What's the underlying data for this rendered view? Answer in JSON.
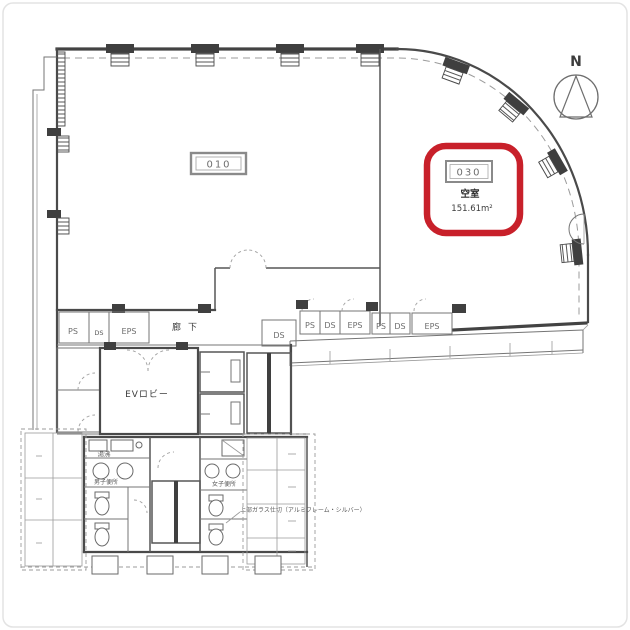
{
  "plan": {
    "compass_label": "N",
    "room_label": "010",
    "highlight": {
      "unit": "030",
      "status": "空室",
      "area": "151.61m²"
    },
    "labels": {
      "corridor": "廊下",
      "ev_lobby": "EVロビー",
      "kitchenette": "湯沸",
      "mens_toilet": "男子便所",
      "womens_toilet": "女子便所",
      "partition_note": "上部ガラス仕切（アルミフレーム・シルバー）"
    },
    "utilities": {
      "left": [
        "PS",
        "DS",
        "EPS"
      ],
      "duct": "DS",
      "right": [
        "PS",
        "DS",
        "EPS",
        "PS",
        "DS",
        "EPS"
      ]
    },
    "colors": {
      "highlight": "#c8202a",
      "wall": "#4a4a4a"
    }
  }
}
